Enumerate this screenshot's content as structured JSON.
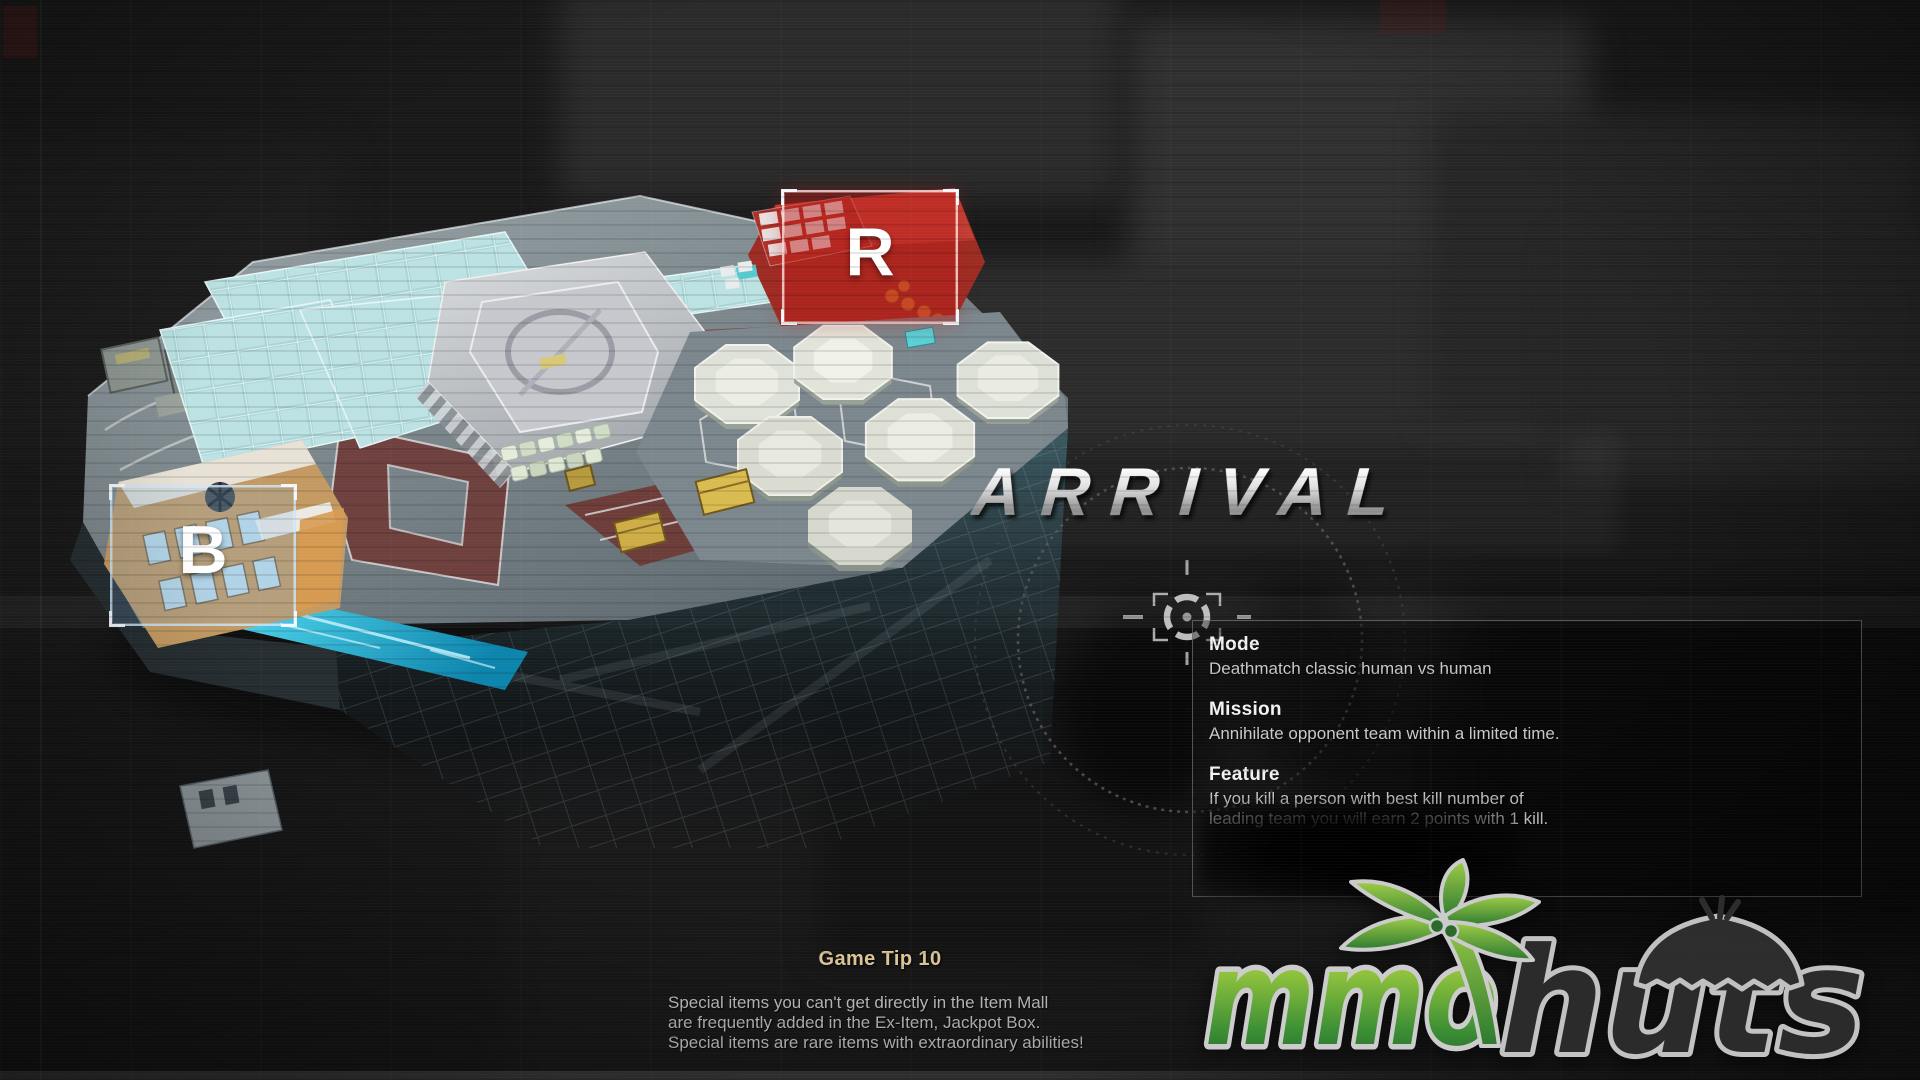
{
  "screen": {
    "map_title": "ARRIVAL",
    "markers": {
      "red_label": "R",
      "blue_label": "B"
    },
    "info_panel": {
      "mode_label": "Mode",
      "mode_text": "Deathmatch classic human vs human",
      "mission_label": "Mission",
      "mission_text": "Annihilate opponent team within a limited time.",
      "feature_label": "Feature",
      "feature_line1": " If you kill a person with best kill number of",
      "feature_line2": "leading team you will earn 2 points with 1 kill."
    },
    "game_tip": {
      "title": "Game Tip 10",
      "line1": "Special items you can't get directly in the Item Mall",
      "line2": "are frequently added in the Ex-Item, Jackpot Box.",
      "line3": "Special items are rare items with extraordinary abilities!"
    },
    "branding": {
      "word1": "mmo",
      "word2": "huts"
    },
    "colors": {
      "tip_title_gold": "#e6cf9f",
      "marker_red": "#b91c16",
      "marker_blue_border": "#cde8ff",
      "logo_green": "#6ab23e",
      "title_metal": "#d9d9d9",
      "solar_cyan": "#a9d5d7",
      "road_maroon": "#6e3c38",
      "water_cyan": "#2fc4e4"
    }
  }
}
